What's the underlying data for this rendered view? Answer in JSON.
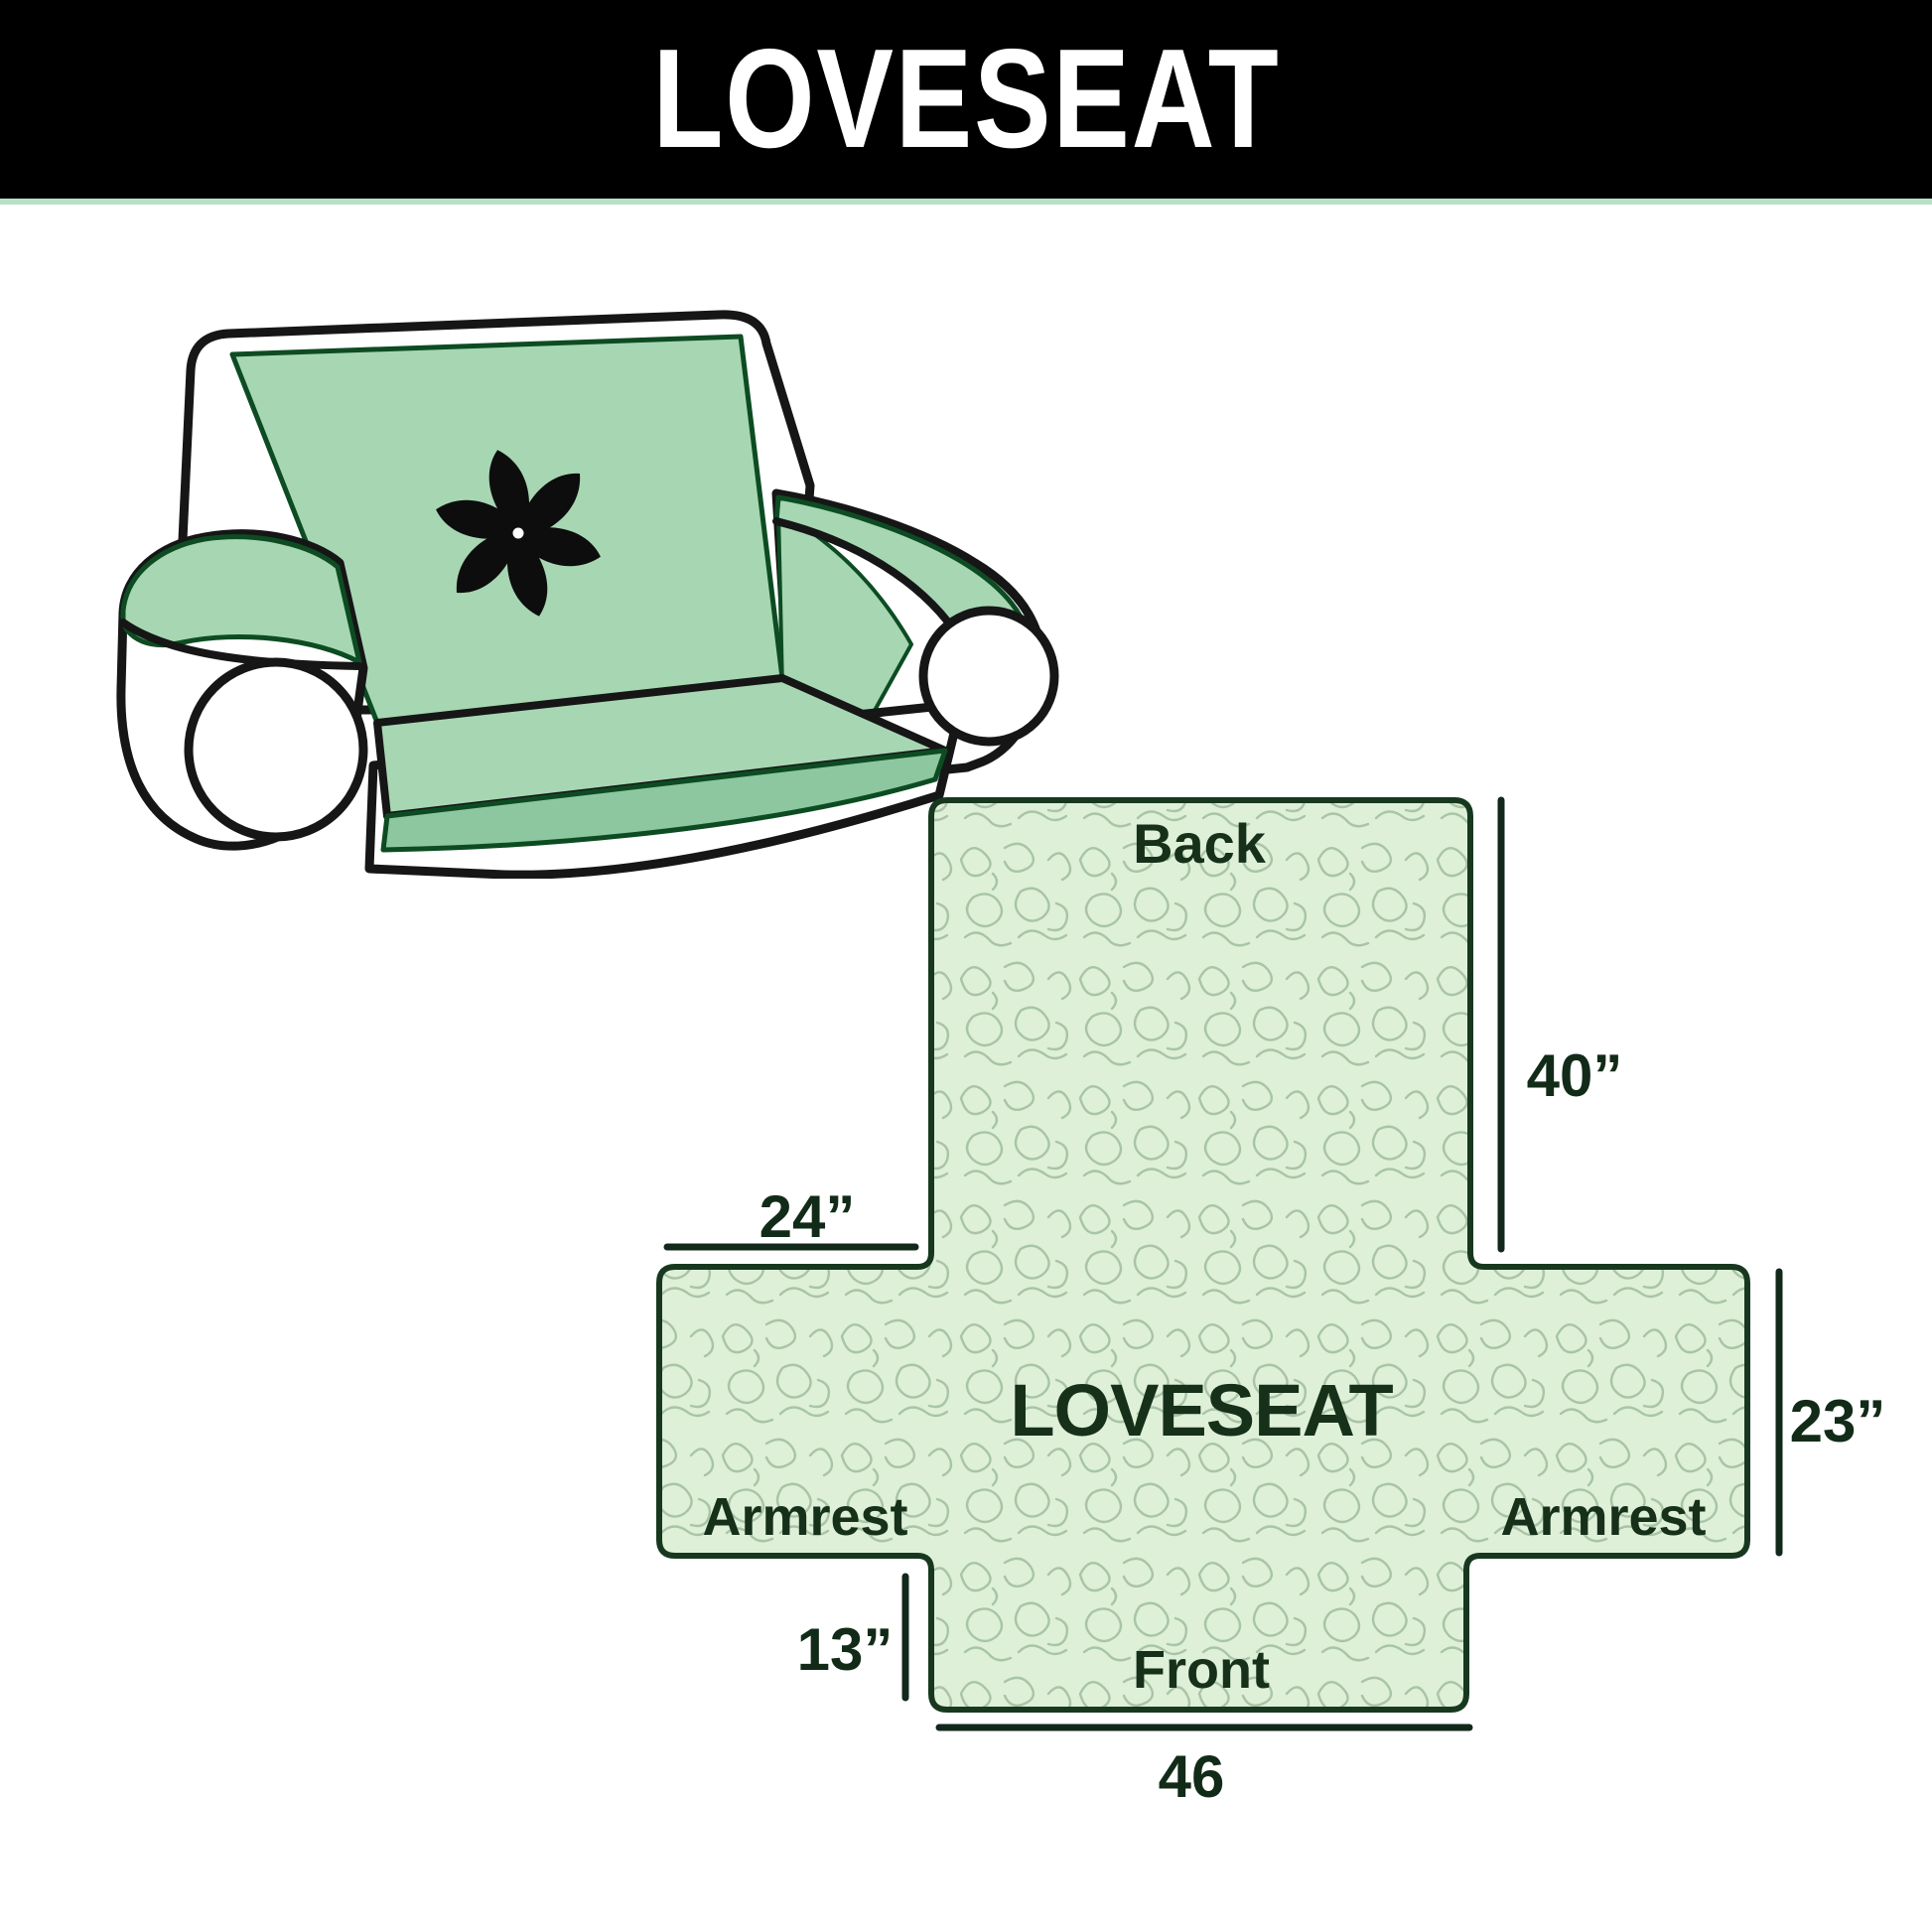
{
  "header": {
    "title": "LOVESEAT",
    "bar_color": "#000000",
    "accent_line_color": "#b7e0c6",
    "title_color": "#ffffff"
  },
  "sofa_illustration": {
    "description": "line drawing of a loveseat with quilted slipcover",
    "cover_color": "#a7d6b3",
    "seat_front_color": "#8cc7a0",
    "outline_color": "#161616",
    "logo": "pinwheel-icon",
    "logo_color": "#0d0d0d"
  },
  "diagram": {
    "product_label": "LOVESEAT",
    "sections": {
      "back": "Back",
      "front": "Front",
      "armrest_left": "Armrest",
      "armrest_right": "Armrest"
    },
    "dimensions": {
      "back_height": "40”",
      "armrest_top_width": "24”",
      "armrest_side_height": "23”",
      "front_side_height": "13”",
      "front_bottom_width": "46"
    },
    "colors": {
      "fill": "#def0d8",
      "pattern_stroke": "#a9c4a6",
      "outline": "#17381f",
      "dimension_line": "#11281a",
      "label_text": "#16301a"
    }
  }
}
